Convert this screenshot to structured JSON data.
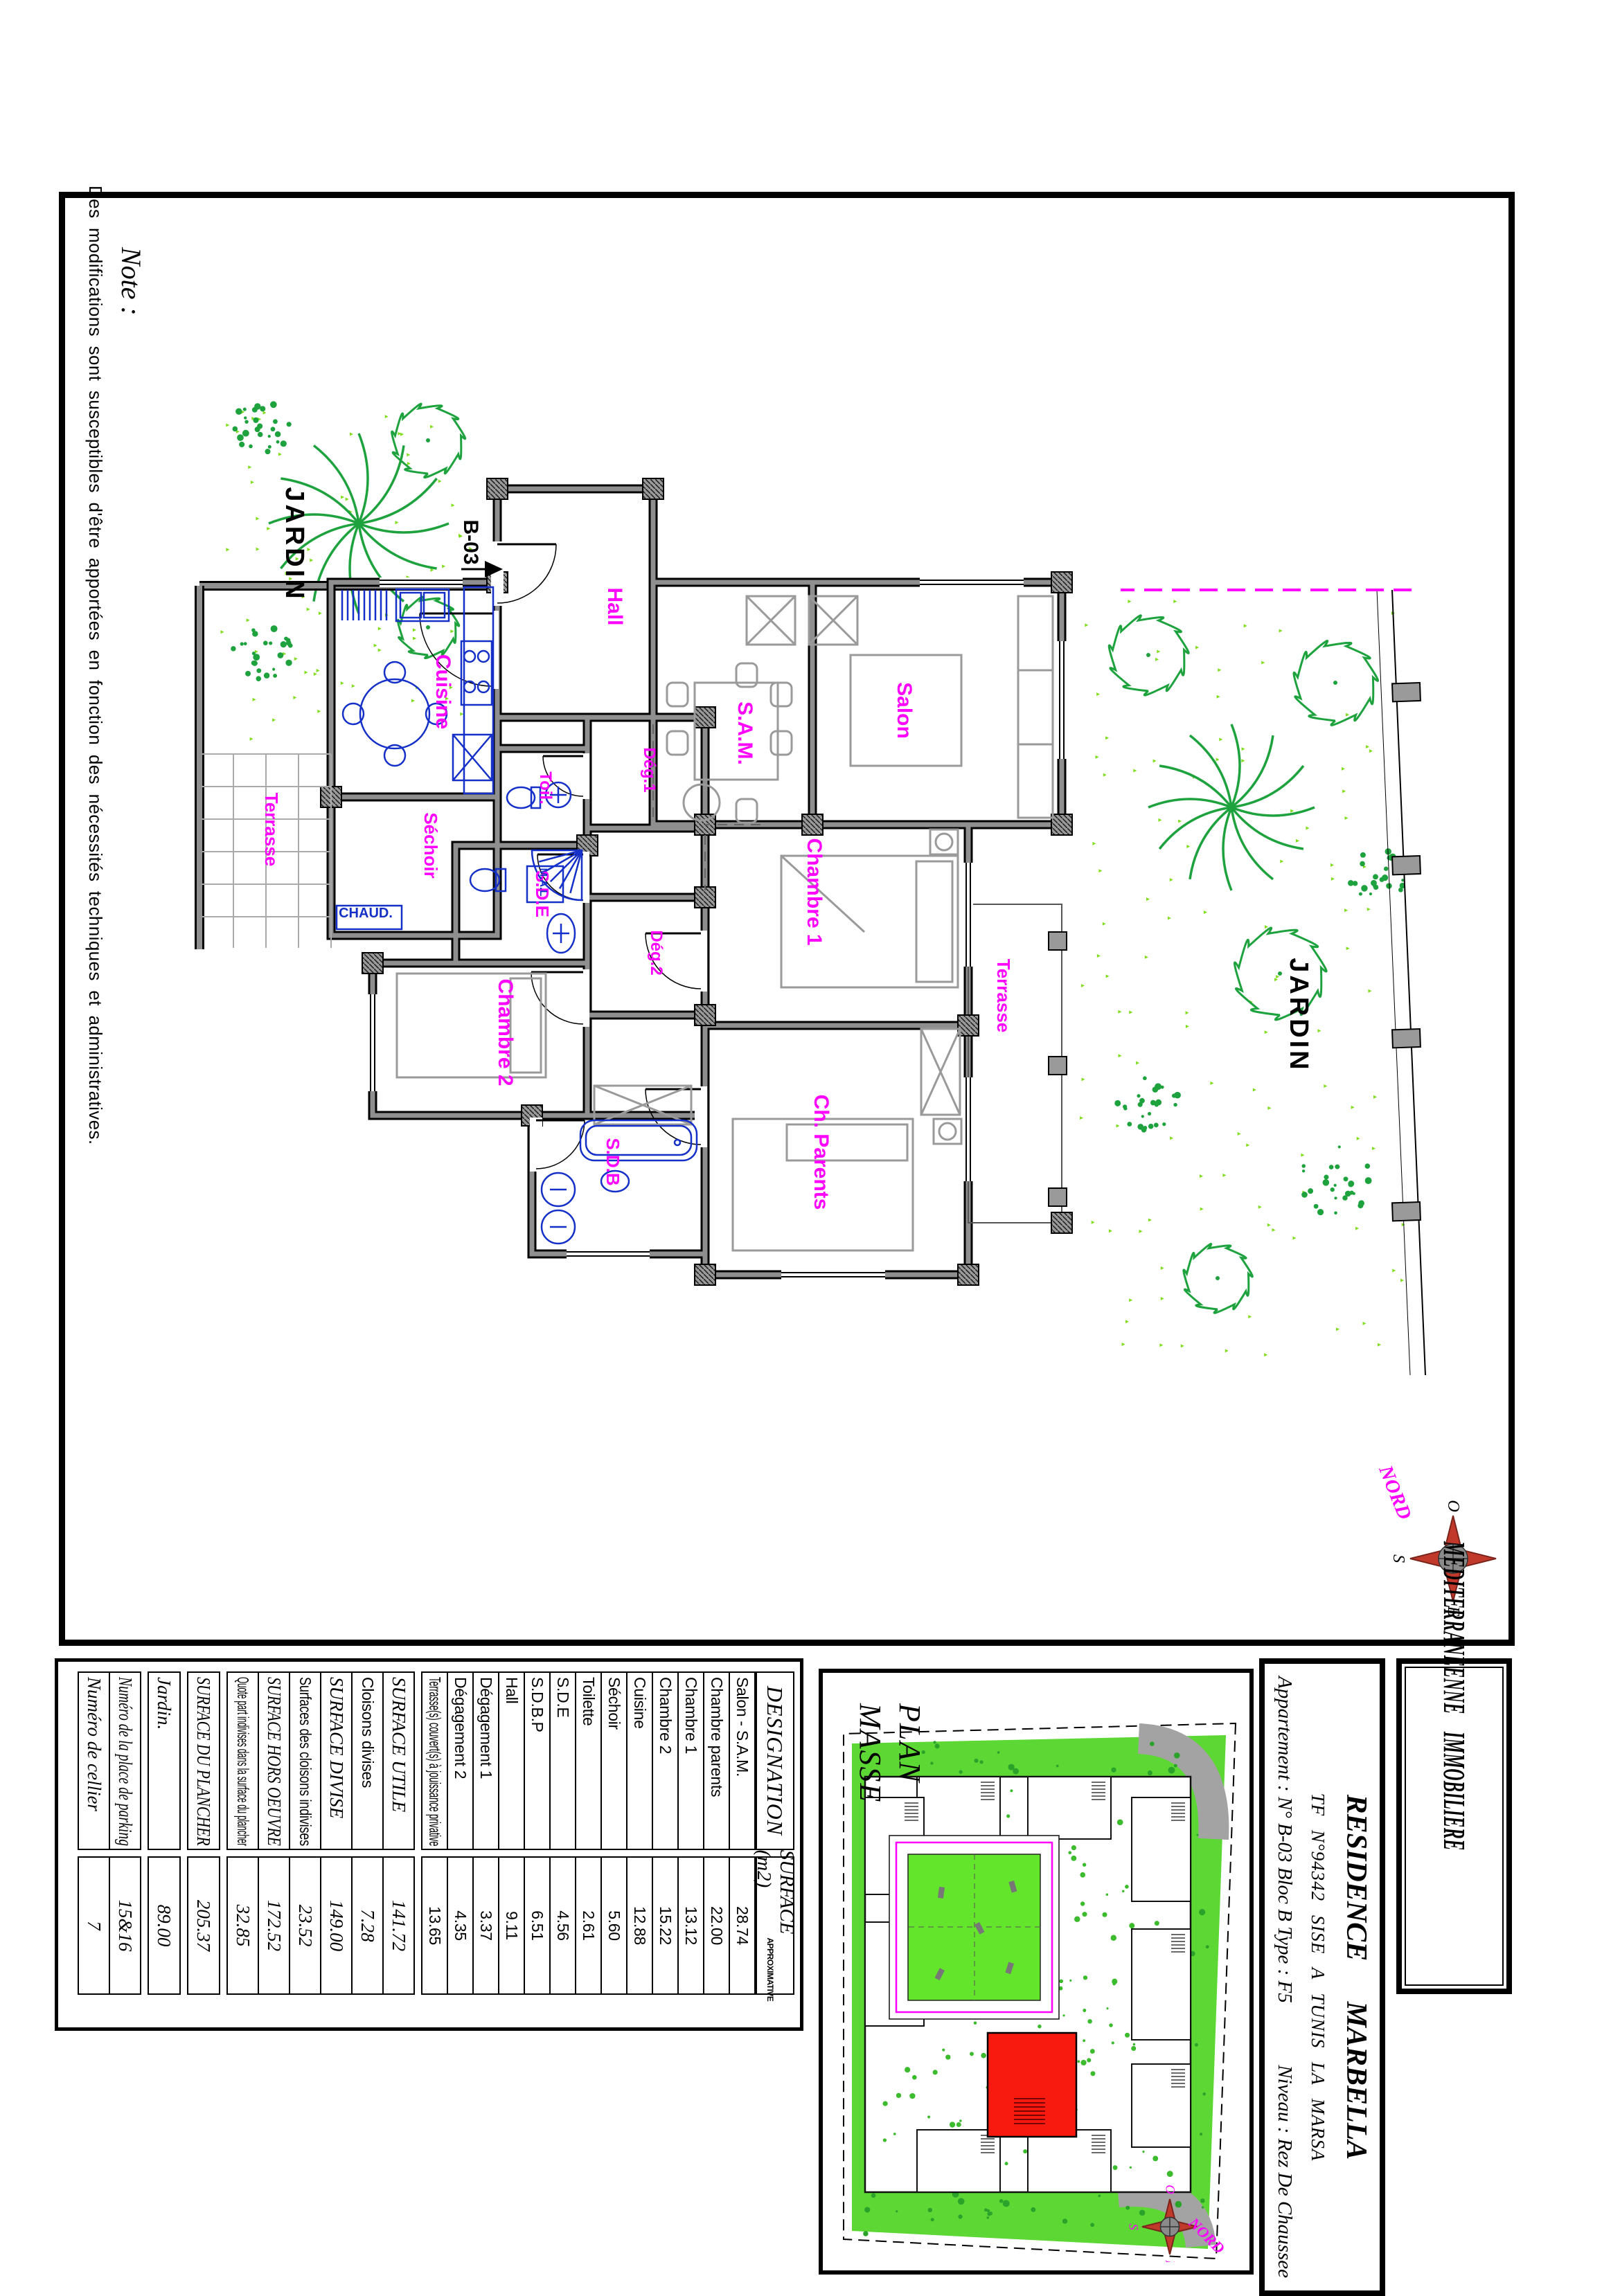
{
  "note": {
    "title": "Note :",
    "body": "Des modifications sont susceptibles d'être apportées en fonction des nécessités techniques et administratives."
  },
  "title_block": {
    "company": "MEDITERRANEENNE IMMOBILIERE",
    "project": "RESIDENCE MARBELLA",
    "tf_line": "TF N°94342  SISE A TUNIS LA MARSA",
    "apartment_line": "Appartement : N° B-03 Bloc B Type : F5",
    "level_line": "Niveau : Rez De Chaussee"
  },
  "plan_masse": {
    "title_line1": "PLAN",
    "title_line2": "MASSE",
    "compass": {
      "north": "NORD",
      "west": "O",
      "south": "S",
      "east": "E"
    }
  },
  "floor_plan": {
    "unit": "B-03",
    "compass": {
      "north": "NORD",
      "west": "O",
      "south": "S",
      "east": "E"
    },
    "labels": {
      "hall": "Hall",
      "salon": "Salon",
      "sam": "S.A.M.",
      "cuisine": "Cuisine",
      "sechoir": "Séchoir",
      "toil": "Toil.",
      "deg1": "Dég.1",
      "deg2": "Dég.2",
      "sde": "S.D.E",
      "sdb": "S.D.B",
      "chambre1": "Chambre 1",
      "chambre2": "Chambre 2",
      "chparents": "Ch. Parents",
      "terrasse_top": "Terrasse",
      "terrasse_grid": "Terrasse",
      "jardin_top": "JARDIN",
      "jardin_left": "JARDIN",
      "mal": "M.A.L",
      "chaud": "CHAUD."
    },
    "colors": {
      "label": "#ff00ff",
      "fixtures": "#1430c8",
      "walls": "#8f8f8f",
      "tree": "#1da23e",
      "speckle": "#7fdd1c",
      "furniture": "#9a9a9a"
    }
  },
  "surface_table": {
    "header": {
      "designation": "DESIGNATION",
      "surface": "SURFACE (m2)",
      "surface_sub": "APPROXIMATIVE"
    },
    "groups": [
      {
        "h": "hA",
        "rows": [
          {
            "l": "Salon - S.A.M.",
            "v": "28.74",
            "ls": "sans",
            "vs": "sans"
          },
          {
            "l": "Chambre parents",
            "v": "22.00",
            "ls": "sans",
            "vs": "sans"
          },
          {
            "l": "Chambre 1",
            "v": "13.12",
            "ls": "sans",
            "vs": "sans"
          },
          {
            "l": "Chambre 2",
            "v": "15.22",
            "ls": "sans",
            "vs": "sans"
          },
          {
            "l": "Cuisine",
            "v": "12.88",
            "ls": "sans",
            "vs": "sans"
          },
          {
            "l": "Séchoir",
            "v": "5.60",
            "ls": "sans",
            "vs": "sans"
          },
          {
            "l": "Toilette",
            "v": "2.61",
            "ls": "sans",
            "vs": "sans"
          },
          {
            "l": "S.D.E",
            "v": "4.56",
            "ls": "sans",
            "vs": "sans"
          },
          {
            "l": "S.D.B.P",
            "v": "6.51",
            "ls": "sans",
            "vs": "sans"
          },
          {
            "l": "Hall",
            "v": "9.11",
            "ls": "sans",
            "vs": "sans"
          },
          {
            "l": "Dégagement 1",
            "v": "3.37",
            "ls": "sans",
            "vs": "sans"
          },
          {
            "l": "Dégagement 2",
            "v": "4.35",
            "ls": "sans",
            "vs": "sans"
          },
          {
            "l": "Terrasse(s) couvert(s) à jouissance privative",
            "v": "13.65",
            "ls": "sans",
            "vs": "sans"
          }
        ]
      },
      {
        "h": "hB",
        "rows": [
          {
            "l": "SURFACE UTILE",
            "v": "141.72",
            "ls": "serif",
            "vs": "serif"
          },
          {
            "l": "Cloisons divises",
            "v": "7.28",
            "ls": "sans",
            "vs": "serif"
          },
          {
            "l": "SURFACE DIVISE",
            "v": "149.00",
            "ls": "serif",
            "vs": "serif"
          },
          {
            "l": "Surfaces des cloisons indivises",
            "v": "23.52",
            "ls": "sans",
            "vs": "serif"
          },
          {
            "l": "SURFACE HORS OEUVRE",
            "v": "172.52",
            "ls": "serif",
            "vs": "serif"
          },
          {
            "l": "Quote part indivises dans la surface du plancher",
            "v": "32.85",
            "ls": "sans",
            "vs": "serif"
          }
        ]
      },
      {
        "h": "hS",
        "rows": [
          {
            "l": "SURFACE DU PLANCHER",
            "v": "205.37",
            "ls": "serif",
            "vs": "serif"
          }
        ]
      },
      {
        "h": "hS",
        "rows": [
          {
            "l": "Jardin.",
            "v": "89.00",
            "ls": "serif",
            "vs": "serif"
          }
        ]
      },
      {
        "h": "hB",
        "rows": [
          {
            "l": "Numéro de la place de parking",
            "v": "15&16",
            "ls": "serif",
            "vs": "serif"
          },
          {
            "l": "Numéro de cellier",
            "v": "7",
            "ls": "serif",
            "vs": "serif"
          }
        ]
      }
    ]
  }
}
